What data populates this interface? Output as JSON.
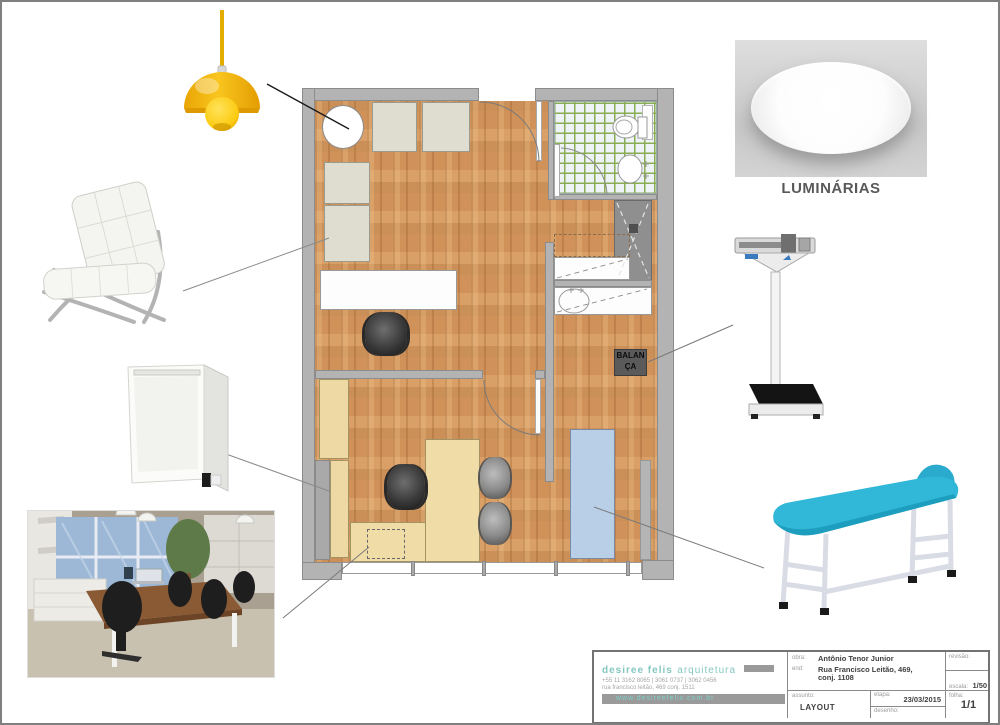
{
  "legend": {
    "luminarias_label": "LUMINÁRIAS"
  },
  "plan": {
    "balanca_line1": "BALAN",
    "balanca_line2": "ÇA"
  },
  "title_block": {
    "logo": {
      "brand_bold": "desiree felis",
      "brand_regular": "arquitetura",
      "phone": "+55 11 3162 8065 | 3061 0737 | 3062 0456",
      "address": "rua francisco leitão, 469 conj. 1511",
      "website": "www.desireefelix.com.br"
    },
    "obra_label": "obra:",
    "obra_value": "Antônio Tenor Junior",
    "end_label": "end:",
    "end_value_line1": "Rua Francisco Leitão, 469,",
    "end_value_line2": "conj. 1108",
    "revisao_label": "revisão:",
    "escala_label": "escala:",
    "escala_value": "1/50",
    "assunto_label": "assunto:",
    "assunto_value": "LAYOUT",
    "etapa_label": "etapa:",
    "etapa_value": "23/03/2015",
    "desenho_label": "desenho:",
    "folha_label": "folha:",
    "folha_value": "1/1"
  },
  "colors": {
    "accent_teal": "#85c7c1",
    "wood_floor": "#d49a62",
    "wall_gray": "#b3b3b3",
    "exam_table_plan_blue": "#b9cfe7",
    "lamp_yellow": "#f6b70f",
    "exam_table_turquoise": "#31b7d8",
    "tile_grout_green": "#8aad53"
  }
}
